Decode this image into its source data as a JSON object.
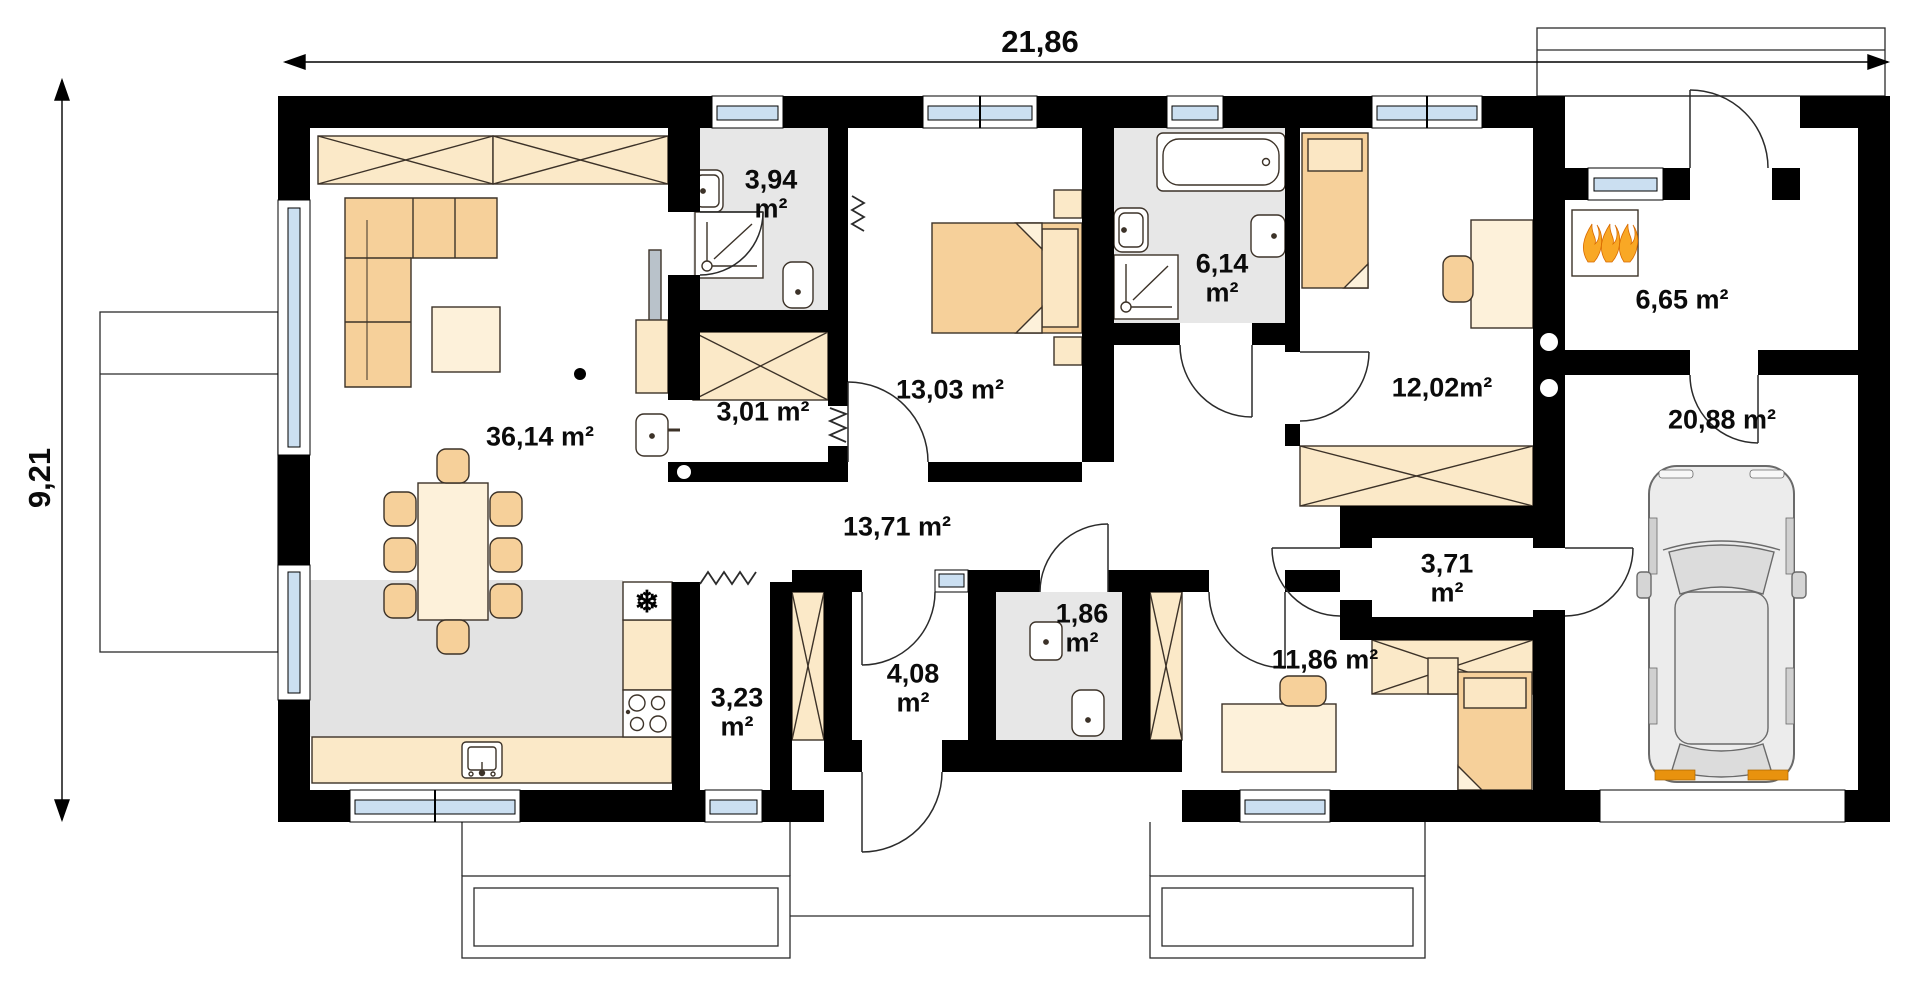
{
  "plan_title": "single-storey house floor plan",
  "dimensions": {
    "total_width": "21,86",
    "total_height": "9,21"
  },
  "rooms": [
    {
      "id": "living-dining",
      "label": "36,14 m²"
    },
    {
      "id": "bathroom-small",
      "label": "3,94\nm²"
    },
    {
      "id": "hall-entry",
      "label": "3,01 m²"
    },
    {
      "id": "bedroom-1",
      "label": "13,03 m²"
    },
    {
      "id": "bathroom-main",
      "label": "6,14\nm²"
    },
    {
      "id": "bedroom-2",
      "label": "12,02m²"
    },
    {
      "id": "boiler-room",
      "label": "6,65 m²"
    },
    {
      "id": "garage",
      "label": "20,88 m²"
    },
    {
      "id": "corridor",
      "label": "13,71 m²"
    },
    {
      "id": "hall-garage",
      "label": "3,71\nm²"
    },
    {
      "id": "wc",
      "label": "1,86\nm²"
    },
    {
      "id": "pantry",
      "label": "3,23\nm²"
    },
    {
      "id": "vestibule",
      "label": "4,08\nm²"
    },
    {
      "id": "bedroom-3",
      "label": "11,86 m²"
    }
  ],
  "icons": {
    "fridge": "❄"
  },
  "colors": {
    "wall": "#000000",
    "furniture_light": "#fbe9c8",
    "furniture_tan": "#f6d09a",
    "furniture_pale": "#fdf1da",
    "floor_gray": "#e7e7e7",
    "window_blue": "#cbdff1",
    "flame_orange": "#f9a825",
    "taillight_orange": "#e8920e"
  }
}
